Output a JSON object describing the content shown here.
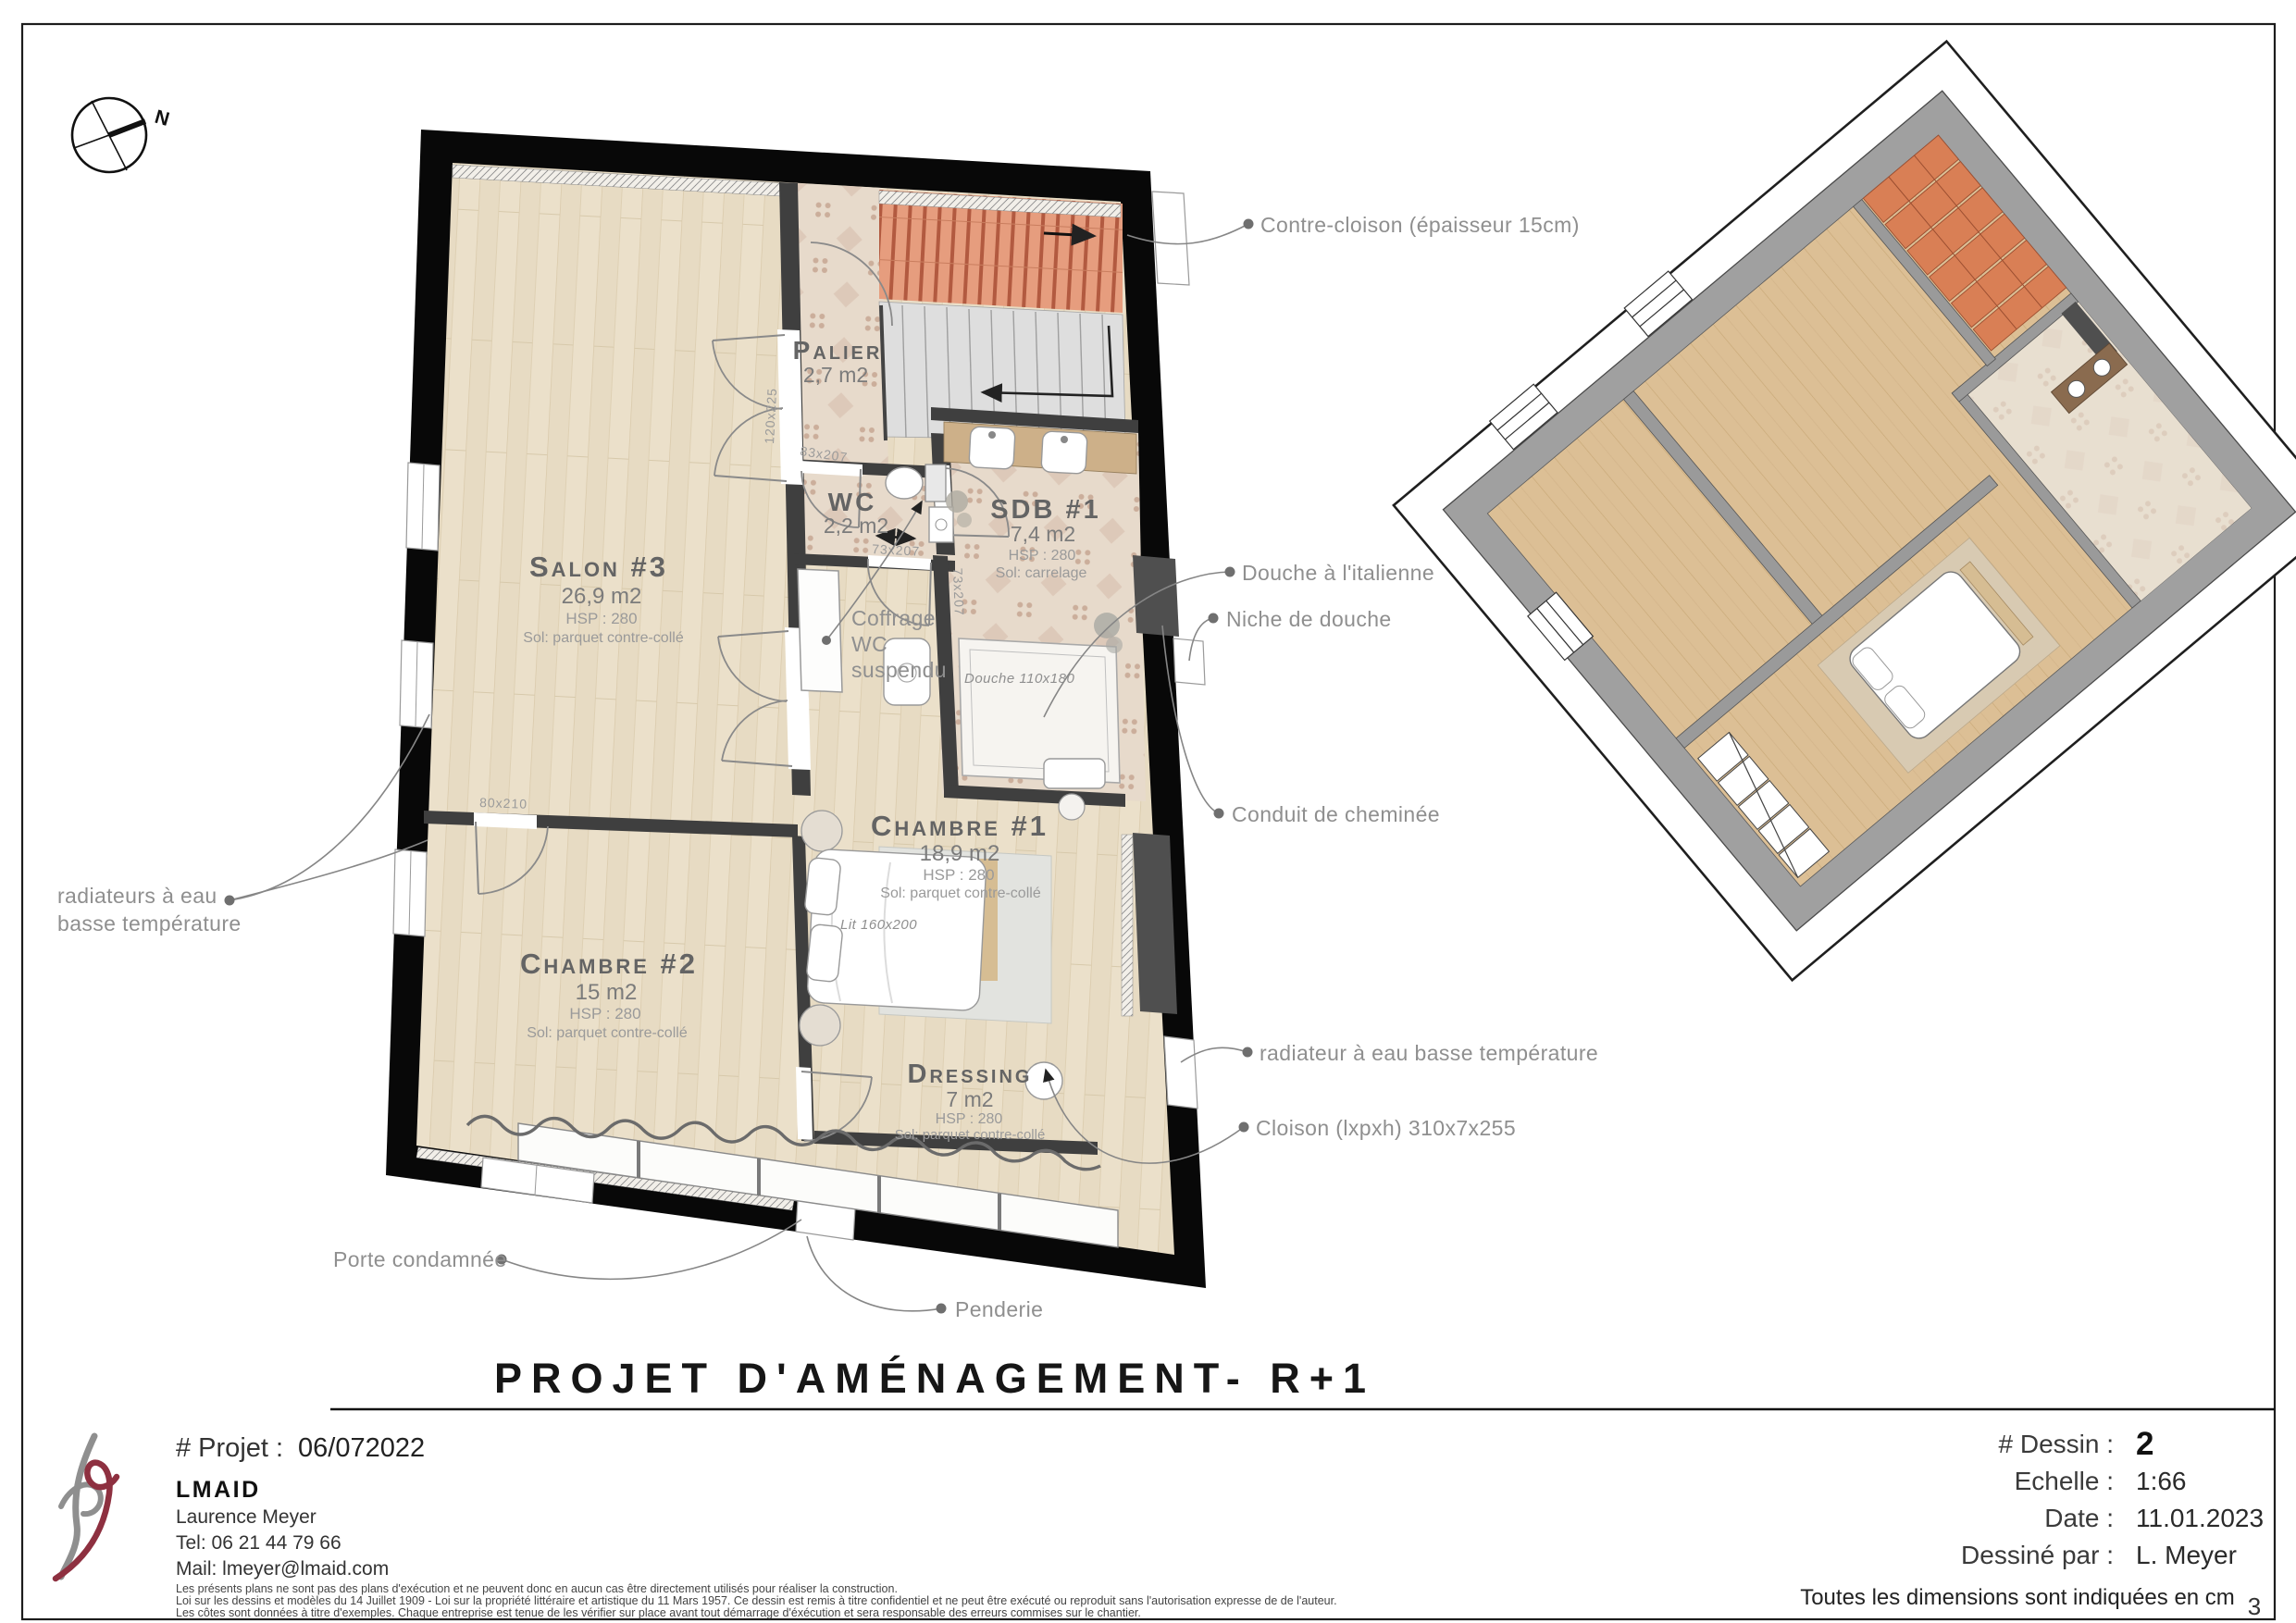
{
  "compass": {
    "north": "N"
  },
  "plan": {
    "title": "Projet d'aménagement- R+1",
    "rooms": {
      "salon": {
        "name": "Salon #3",
        "area": "26,9 m2",
        "hsp": "HSP : 280",
        "sol": "Sol: parquet contre-collé"
      },
      "chambre1": {
        "name": "Chambre #1",
        "area": "18,9 m2",
        "hsp": "HSP : 280",
        "sol": "Sol: parquet contre-collé"
      },
      "chambre2": {
        "name": "Chambre #2",
        "area": "15 m2",
        "hsp": "HSP : 280",
        "sol": "Sol: parquet contre-collé"
      },
      "dressing": {
        "name": "Dressing",
        "area": "7 m2",
        "hsp": "HSP : 280",
        "sol": "Sol: parquet contre-collé"
      },
      "palier": {
        "name": "Palier",
        "area": "2,7 m2"
      },
      "wc": {
        "name": "WC",
        "area": "2,2 m2"
      },
      "sdb": {
        "name": "SDB #1",
        "area": "7,4 m2",
        "hsp": "HSP : 280",
        "sol": "Sol: carrelage"
      }
    },
    "dimensions": {
      "door_salon": "120x225",
      "door_palier": "83x207",
      "door_wc": "73x207",
      "door_sdb": "73x207",
      "door_chambre2": "80x210",
      "lit": "Lit 160x200",
      "douche": "Douche 110x180"
    },
    "annotations": {
      "contre_cloison": "Contre-cloison (épaisseur 15cm)",
      "douche_italienne": "Douche à l'italienne",
      "niche_douche": "Niche de douche",
      "conduit_cheminee": "Conduit de cheminée",
      "radiateur": "radiateur à eau basse température",
      "cloison": "Cloison (lxpxh) 310x7x255",
      "radiateurs_line1": "radiateurs à eau",
      "radiateurs_line2": "basse température",
      "porte_condamnee": "Porte condamnée",
      "penderie": "Penderie",
      "coffrage_line1": "Coffrage",
      "coffrage_line2": "WC",
      "coffrage_line3": "suspendu"
    }
  },
  "footer": {
    "project_label": "# Projet :",
    "project_value": "06/072022",
    "company": "LMAID",
    "author": "Laurence Meyer",
    "tel": "Tel: 06 21 44 79 66",
    "mail": "Mail: lmeyer@lmaid.com",
    "legal_1": "Les présents plans ne sont pas des plans d'exécution et ne peuvent donc en aucun cas être directement utilisés pour réaliser la construction.",
    "legal_2": "Loi sur les dessins et modèles du 14 Juillet 1909 - Loi sur la propriété littéraire et artistique du 11 Mars 1957. Ce dessin est remis à titre confidentiel et ne peut être exécuté ou reproduit sans l'autorisation expresse de de l'auteur.",
    "legal_3": "Les côtes sont données à titre d'exemples. Chaque entreprise est tenue de les vérifier sur place avant tout démarrage d'éxécution et sera responsable des erreurs commises sur le chantier.",
    "dessin_label": "#  Dessin :",
    "dessin_value": "2",
    "echelle_label": "Echelle :",
    "echelle_value": "1:66",
    "date_label": "Date :",
    "date_value": "11.01.2023",
    "dessine_label": "Dessiné par :",
    "dessine_value": "L. Meyer",
    "dimensions_note": "Toutes les dimensions sont indiquées en cm",
    "page_number": "3"
  }
}
